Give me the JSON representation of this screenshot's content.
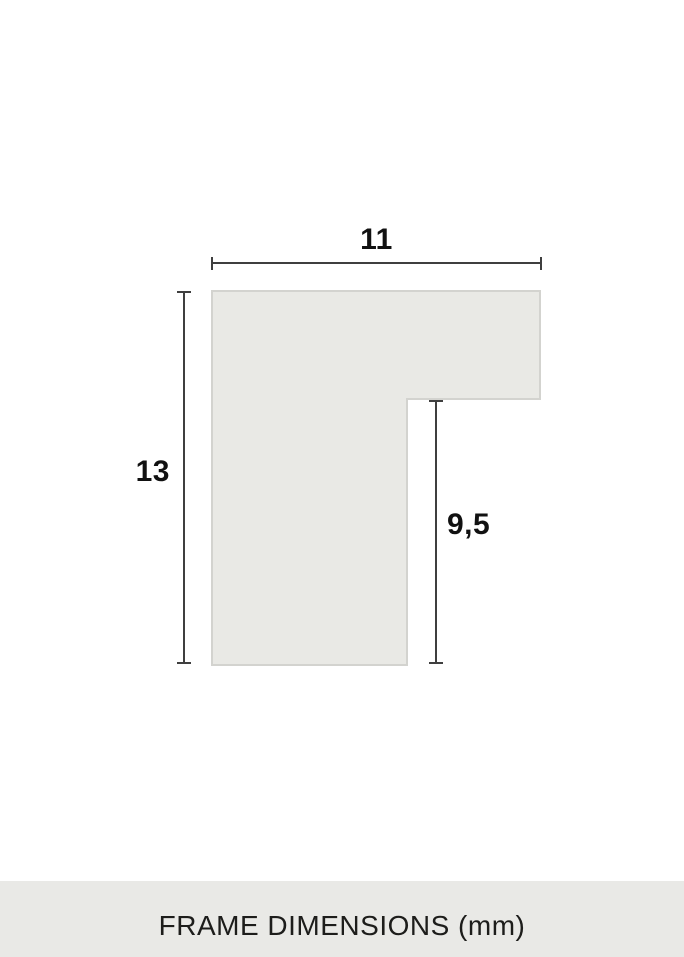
{
  "diagram": {
    "type": "technical-dimension-diagram",
    "unit": "mm",
    "title": "FRAME DIMENSIONS (mm)",
    "dimensions": {
      "width": {
        "label": "11",
        "value": 11
      },
      "height": {
        "label": "13",
        "value": 13
      },
      "rabbet": {
        "label": "9,5",
        "value": 9.5
      }
    },
    "colors": {
      "background": "#ffffff",
      "profile_fill": "#e9e9e5",
      "profile_border": "#d3d3cf",
      "dimension_line": "#3f3f3f",
      "footer_background": "#e9e9e6",
      "text": "#1a1a1a"
    }
  }
}
